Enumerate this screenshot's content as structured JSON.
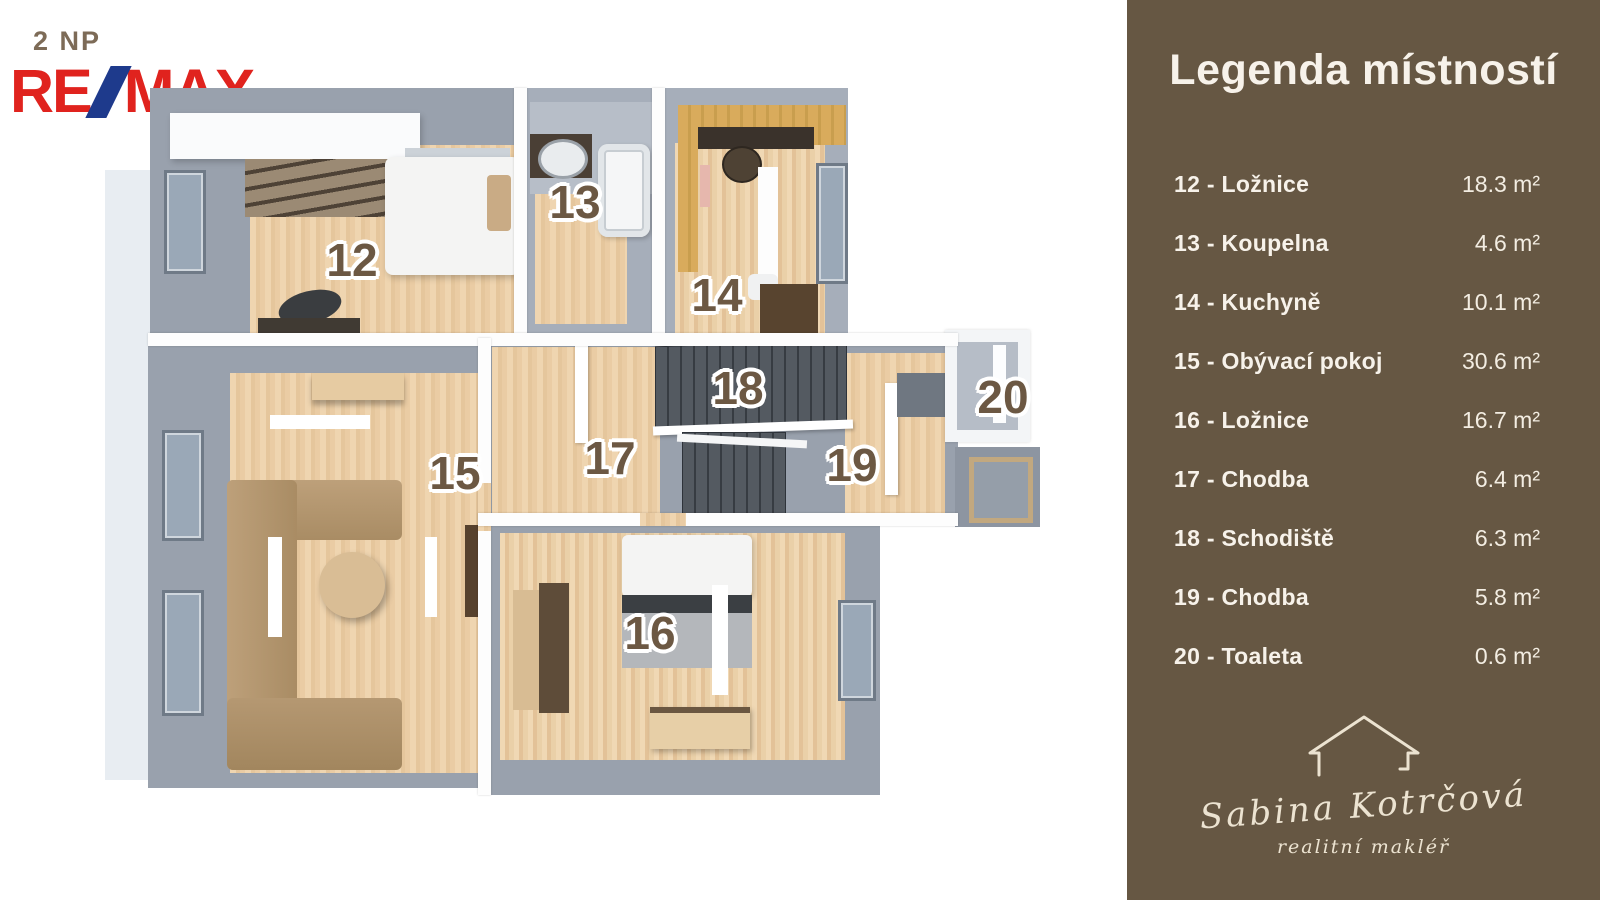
{
  "header": {
    "floor_label": "2 NP",
    "brand": {
      "re": "RE",
      "max": "MAX"
    }
  },
  "legend": {
    "title": "Legenda místností",
    "items": [
      {
        "label": "12 - Ložnice",
        "area": "18.3 m²"
      },
      {
        "label": "13 - Koupelna",
        "area": "4.6 m²"
      },
      {
        "label": "14 - Kuchyně",
        "area": "10.1 m²"
      },
      {
        "label": "15 - Obývací pokoj",
        "area": "30.6 m²"
      },
      {
        "label": "16 - Ložnice",
        "area": "16.7 m²"
      },
      {
        "label": "17 - Chodba",
        "area": "6.4 m²"
      },
      {
        "label": "18 - Schodiště",
        "area": "6.3 m²"
      },
      {
        "label": "19 - Chodba",
        "area": "5.8 m²"
      },
      {
        "label": "20 - Toaleta",
        "area": "0.6 m²"
      }
    ]
  },
  "floorplan": {
    "rooms": [
      {
        "number": "12",
        "name": "Ložnice"
      },
      {
        "number": "13",
        "name": "Koupelna"
      },
      {
        "number": "14",
        "name": "Kuchyně"
      },
      {
        "number": "15",
        "name": "Obývací pokoj"
      },
      {
        "number": "16",
        "name": "Ložnice"
      },
      {
        "number": "17",
        "name": "Chodba"
      },
      {
        "number": "18",
        "name": "Schodiště"
      },
      {
        "number": "19",
        "name": "Chodba"
      },
      {
        "number": "20",
        "name": "Toaleta"
      }
    ]
  },
  "agent": {
    "name": "Sabina Kotrčová",
    "role": "realitní makléř"
  },
  "colors": {
    "panel_brown": "#665743",
    "remax_red": "#e0231e",
    "remax_blue": "#1e3a8c",
    "room_label_brown": "#6c5843",
    "floor_label_brown": "#7d6b57",
    "wood_floor": "#ead0a8",
    "wall_gray": "#99a1ad",
    "signature_cream": "#ece3d1"
  }
}
